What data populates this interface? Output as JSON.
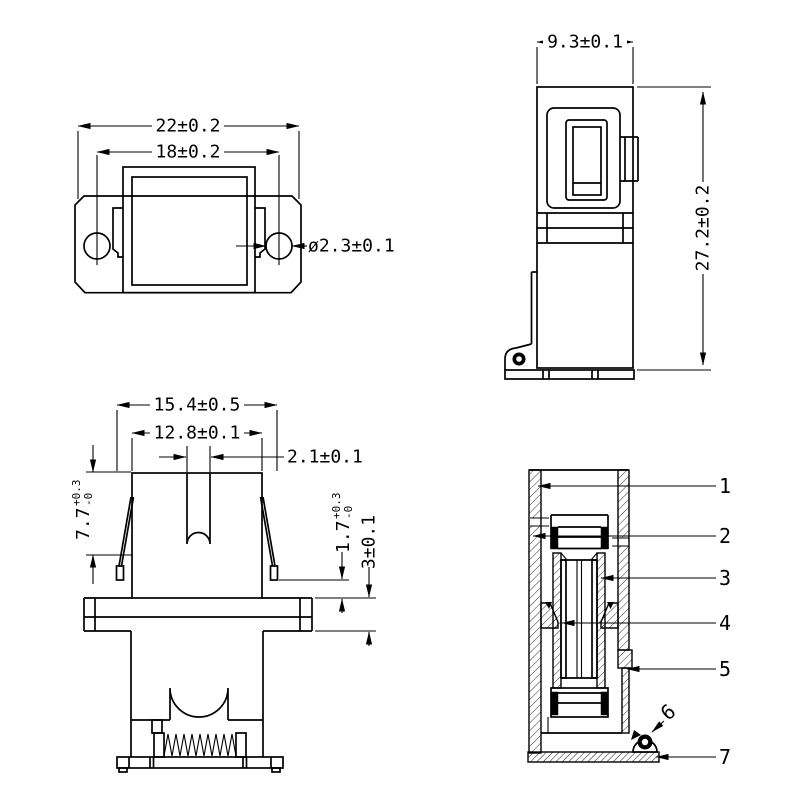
{
  "drawing": {
    "background": "#ffffff",
    "line_color": "#000000",
    "views": {
      "front": {
        "dims": {
          "outer_width": "22±0.2",
          "hole_pitch": "18±0.2",
          "hole_dia": "ø2.3±0.1"
        }
      },
      "side": {
        "dims": {
          "width": "9.3±0.1",
          "height": "27.2±0.2"
        }
      },
      "bottom": {
        "dims": {
          "outer_width": "15.4±0.5",
          "inner_width": "12.8±0.1",
          "slot_width": "2.1±0.1",
          "depth_value": "7.7",
          "depth_tol_plus": "+0.3",
          "depth_tol_minus": "-0",
          "lip_value": "1.7",
          "lip_tol_plus": "+0.3",
          "lip_tol_minus": "-0",
          "flange_thickness": "3±0.1"
        }
      },
      "section": {
        "part_labels": [
          "1",
          "2",
          "3",
          "4",
          "5",
          "6",
          "7"
        ]
      }
    }
  }
}
